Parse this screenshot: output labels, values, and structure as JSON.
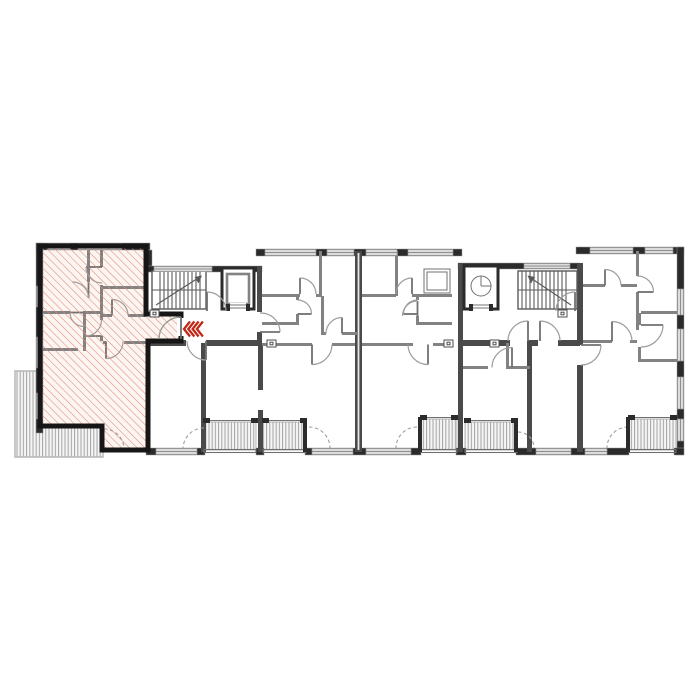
{
  "page": {
    "background": "#ffffff",
    "content": "apartment-building-floor-plan"
  },
  "colors": {
    "wall_exterior": "#2b2b2b",
    "wall_edge": "#9b9b9b",
    "wall_structural": "#4a4a4a",
    "wall_interior": "#828282",
    "unit_outline": "#161616",
    "window_fill": "#dcdcdc",
    "window_line": "#8f8f8f",
    "door_arc": "#9d9d9d",
    "door_leaf": "#707070",
    "hatch_line": "#dd8a74",
    "hatch_bg": "#fdf5f1",
    "deck_stripe": "#a3a3a3",
    "deck_bg": "#f5f5f5",
    "terrace_border": "#b5b5b5",
    "stair_line": "#5a5a5a",
    "marker_red": "#c22718",
    "fixture_border": "#4d4d4d"
  },
  "plan": {
    "highlighted_unit": {
      "id": "apartment-1",
      "state": "selected-hatched",
      "position": "left-end",
      "has_terrace": true
    },
    "other_units": [
      {
        "id": "apartment-2",
        "position": "center-left",
        "balcony": true
      },
      {
        "id": "apartment-3",
        "position": "center-right",
        "balcony": true
      },
      {
        "id": "apartment-4",
        "position": "right-of-center",
        "balcony": true
      },
      {
        "id": "apartment-5",
        "position": "right-end",
        "balcony": true
      }
    ],
    "cores": [
      {
        "id": "stair-core-1",
        "stairs": true,
        "elevator": true,
        "position": "between-unit-1-and-2"
      },
      {
        "id": "stair-core-2",
        "stairs": true,
        "elevator": true,
        "position": "between-unit-4-and-5"
      }
    ],
    "balcony_count": 5,
    "terrace": {
      "position": "bottom-left",
      "finish": "deck-stripes"
    },
    "entrance_marker": {
      "symbol": "nested-chevrons",
      "direction": "left",
      "color": "#c22718"
    }
  }
}
